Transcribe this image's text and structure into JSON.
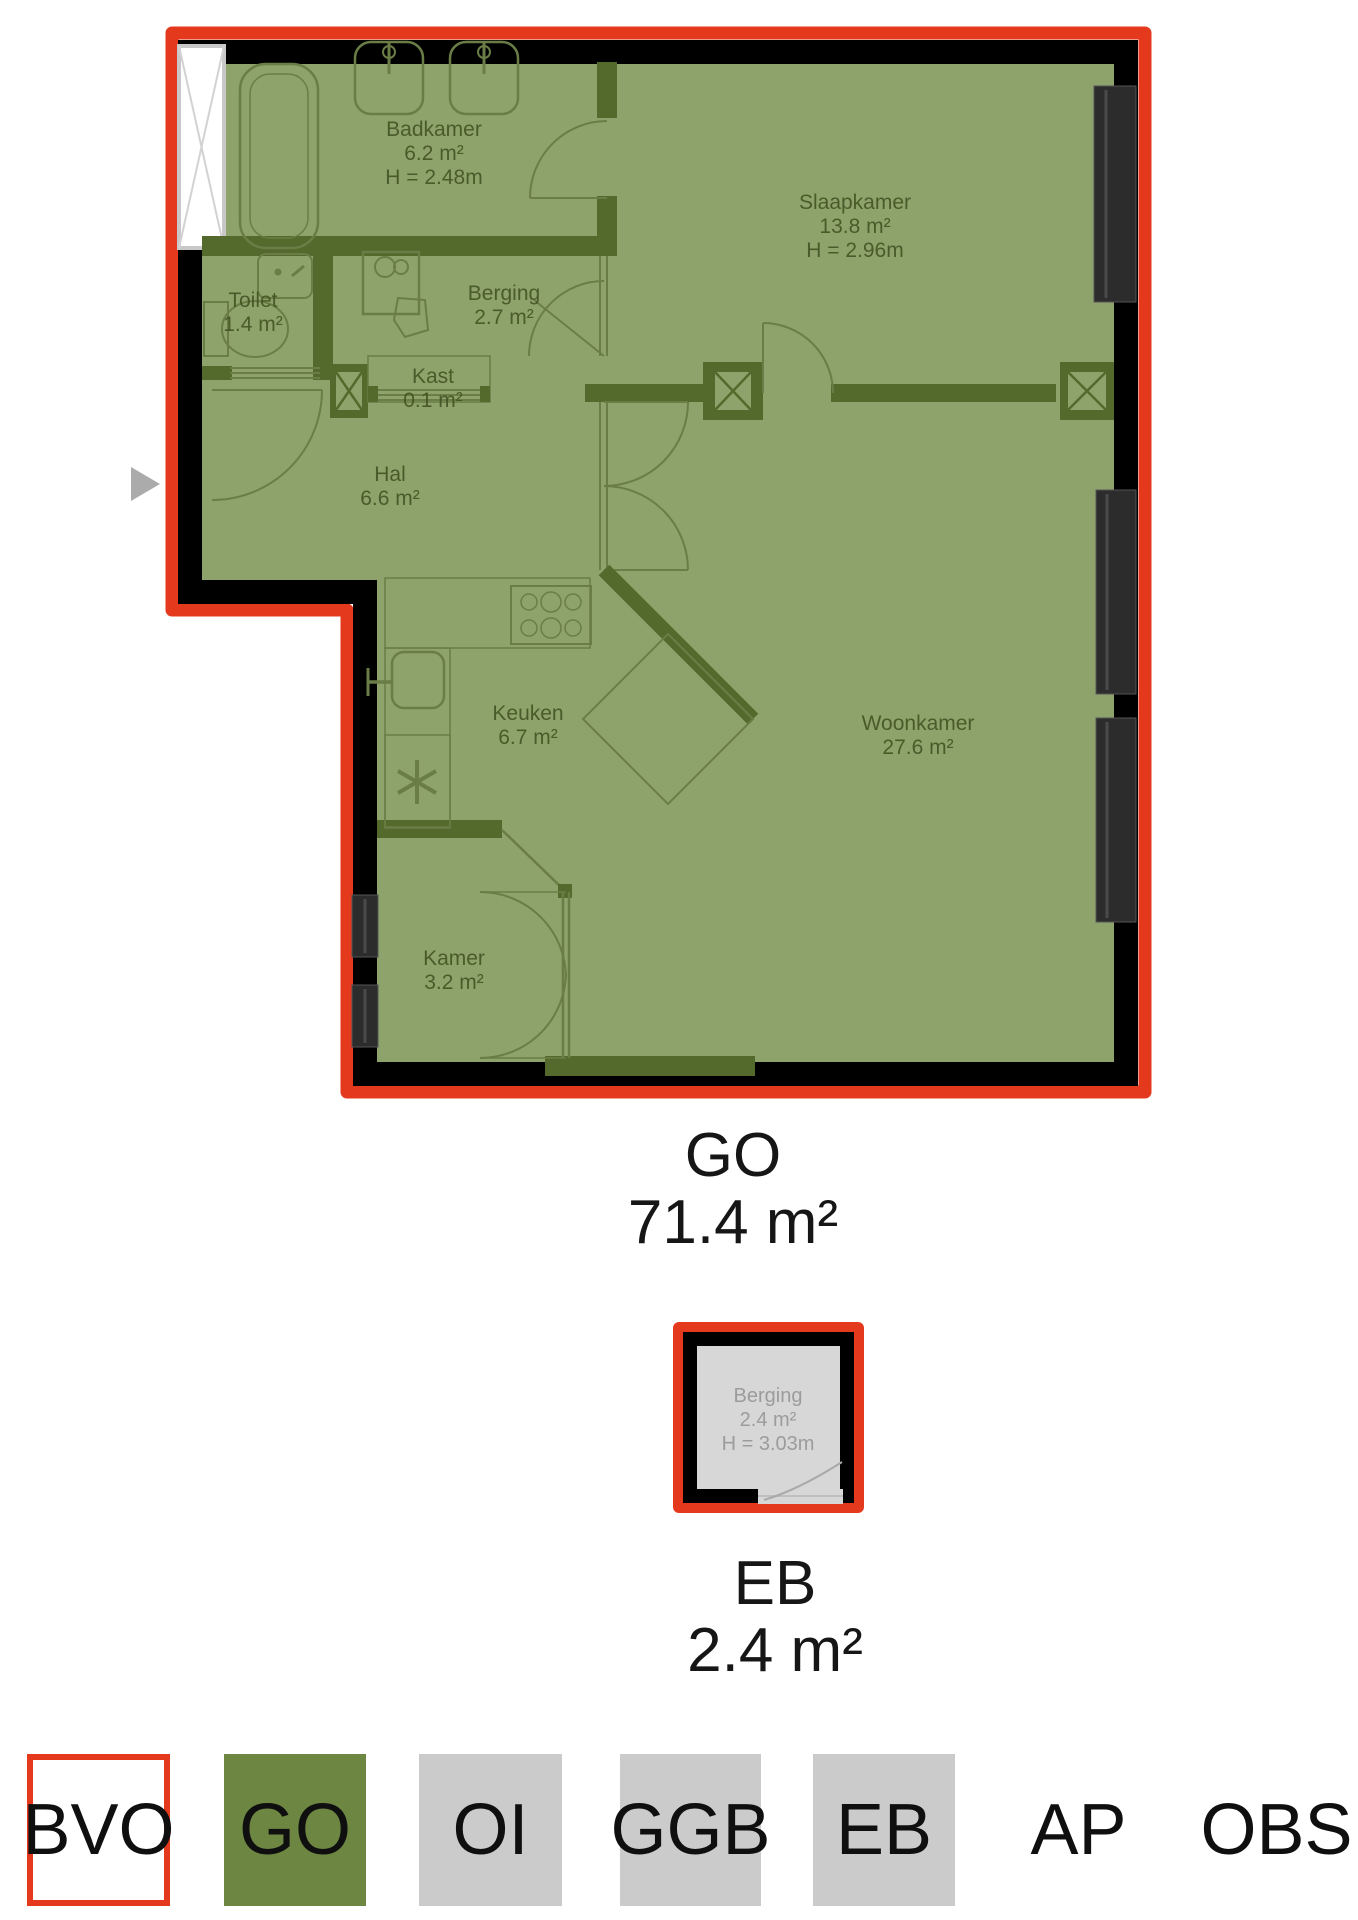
{
  "main_plan": {
    "rooms": [
      {
        "name": "Badkamer",
        "area": "6.2 m²",
        "height": "H = 2.48m"
      },
      {
        "name": "Slaapkamer",
        "area": "13.8 m²",
        "height": "H = 2.96m"
      },
      {
        "name": "Toilet",
        "area": "1.4 m²"
      },
      {
        "name": "Berging",
        "area": "2.7 m²"
      },
      {
        "name": "Kast",
        "area": "0.1 m²"
      },
      {
        "name": "Hal",
        "area": "6.6 m²"
      },
      {
        "name": "Keuken",
        "area": "6.7 m²"
      },
      {
        "name": "Woonkamer",
        "area": "27.6 m²"
      },
      {
        "name": "Kamer",
        "area": "3.2 m²"
      }
    ],
    "caption": {
      "code": "GO",
      "area": "71.4 m²"
    }
  },
  "storage_plan": {
    "room": {
      "name": "Berging",
      "area": "2.4 m²",
      "height": "H = 3.03m"
    },
    "caption": {
      "code": "EB",
      "area": "2.4 m²"
    }
  },
  "legend": {
    "items": [
      {
        "code": "BVO"
      },
      {
        "code": "GO"
      },
      {
        "code": "OI"
      },
      {
        "code": "GGB"
      },
      {
        "code": "EB"
      },
      {
        "code": "AP"
      },
      {
        "code": "OBS"
      }
    ]
  },
  "colors": {
    "outline_red": "#e5391e",
    "room_green": "#8da36b",
    "wall_olive": "#536a2c",
    "wall_black": "#000000",
    "storage_gray": "#d7d7d7",
    "legend_gray": "#cbcbcb",
    "legend_green": "#6d8743"
  }
}
